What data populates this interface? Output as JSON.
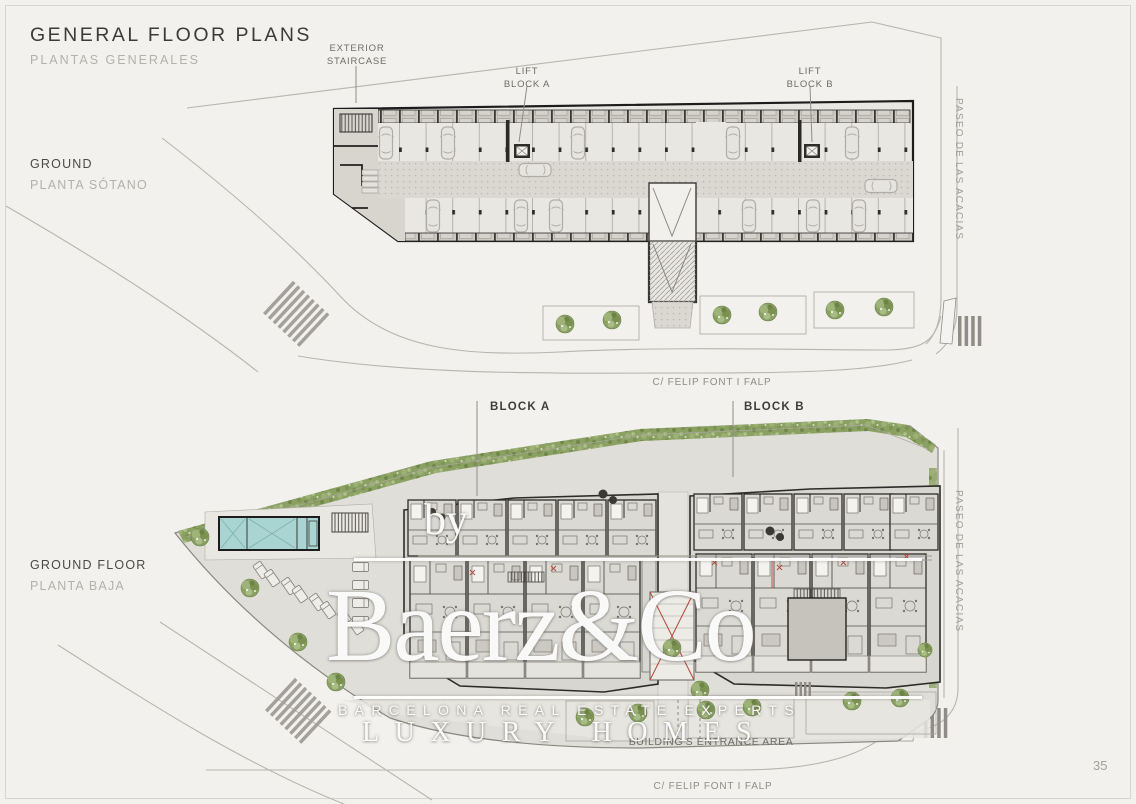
{
  "page": {
    "title": "GENERAL FLOOR PLANS",
    "subtitle": "PLANTAS GENERALES",
    "number": "35"
  },
  "watermark": {
    "prefix": "by",
    "brand": "Baerz&Co",
    "tagline": "BARCELONA REAL ESTATE EXPERTS",
    "tagline2": "LUXURY HOMES"
  },
  "basement": {
    "label_en": "GROUND",
    "label_es": "PLANTA SÓTANO",
    "annotations": {
      "staircase_line1": "EXTERIOR",
      "staircase_line2": "STAIRCASE",
      "lift_a_line1": "LIFT",
      "lift_a_line2": "BLOCK A",
      "lift_b_line1": "LIFT",
      "lift_b_line2": "BLOCK B"
    }
  },
  "ground_floor": {
    "label_en": "GROUND FLOOR",
    "label_es": "PLANTA BAJA",
    "annotations": {
      "block_a": "BLOCK A",
      "block_b": "BLOCK B",
      "entrance": "BUILDING'S ENTRANCE AREA"
    }
  },
  "streets": {
    "east": "PASEO DE LAS ACACIAS",
    "south": "C/ FELIP FONT I FALP"
  },
  "colors": {
    "hedge_green": "#8ba164",
    "pool_water": "#a9d4d2",
    "wall_dark": "#1c1c1c",
    "plan_fill": "#e9e7e2"
  }
}
